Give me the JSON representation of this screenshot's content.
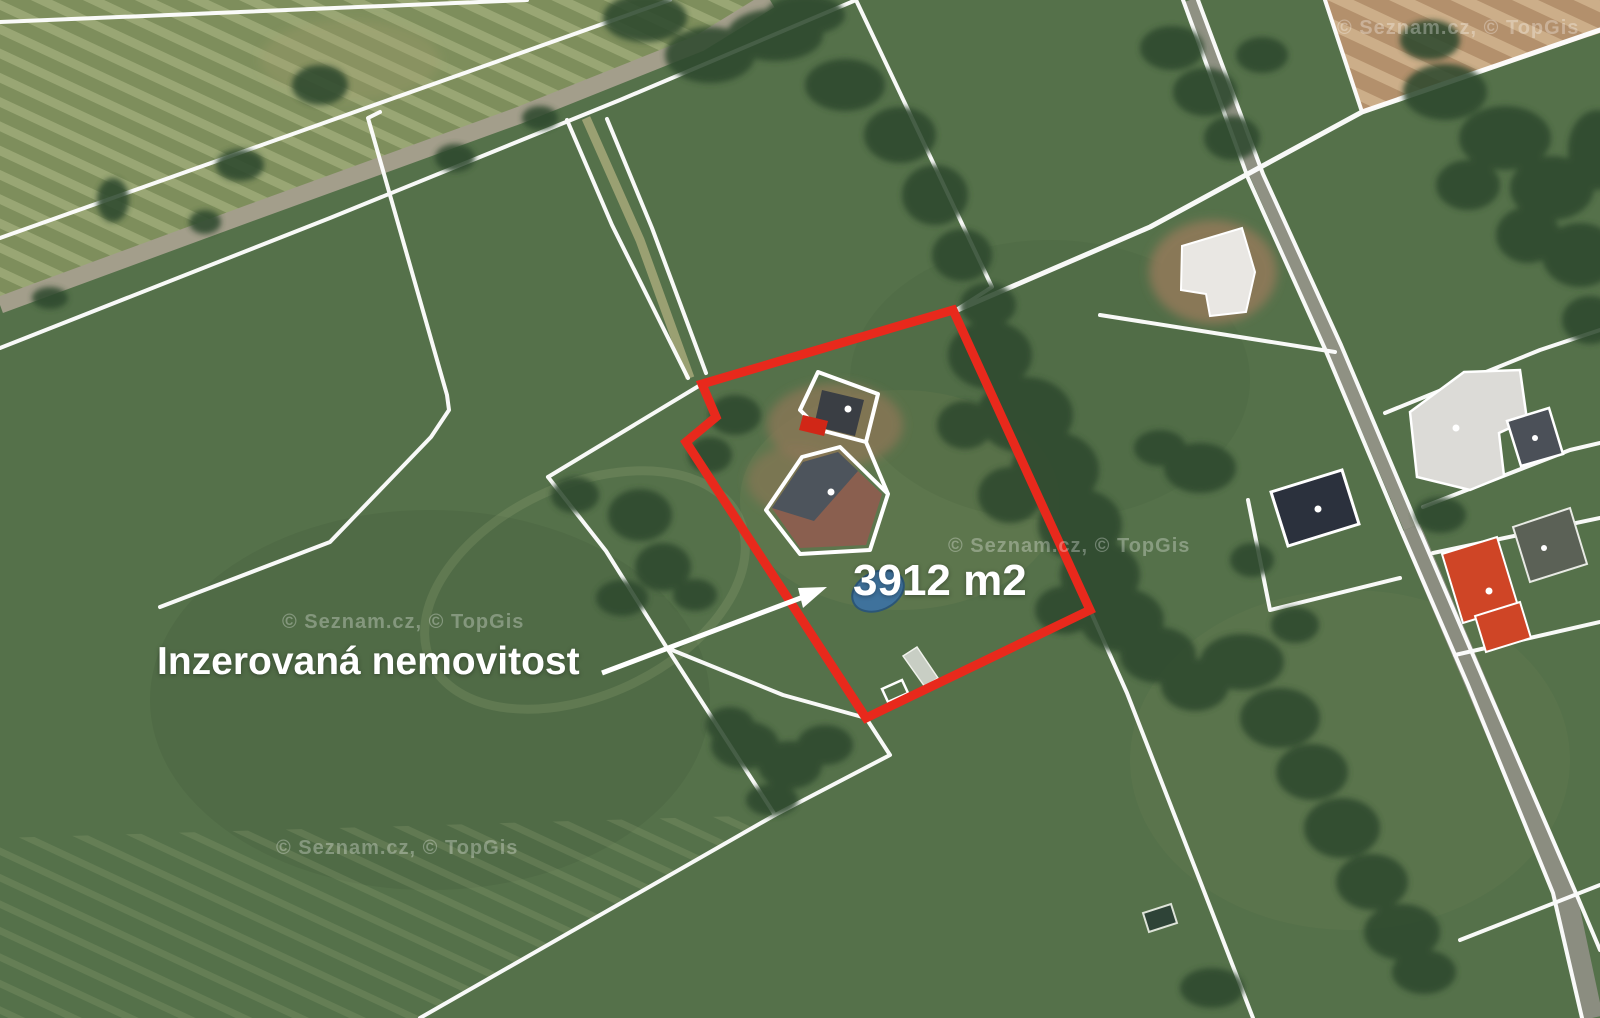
{
  "map": {
    "annotations": {
      "area_label": "3912 m2",
      "property_label": "Inzerovaná nemovitost"
    },
    "watermark": "© Seznam.cz, © TopGis",
    "colors": {
      "highlight_red": "#e8291c",
      "cadastral_line_white": "#ffffff",
      "pond_blue": "#3f729c",
      "field_green": "#55714a",
      "bare_field_tan": "#b3906c"
    }
  }
}
